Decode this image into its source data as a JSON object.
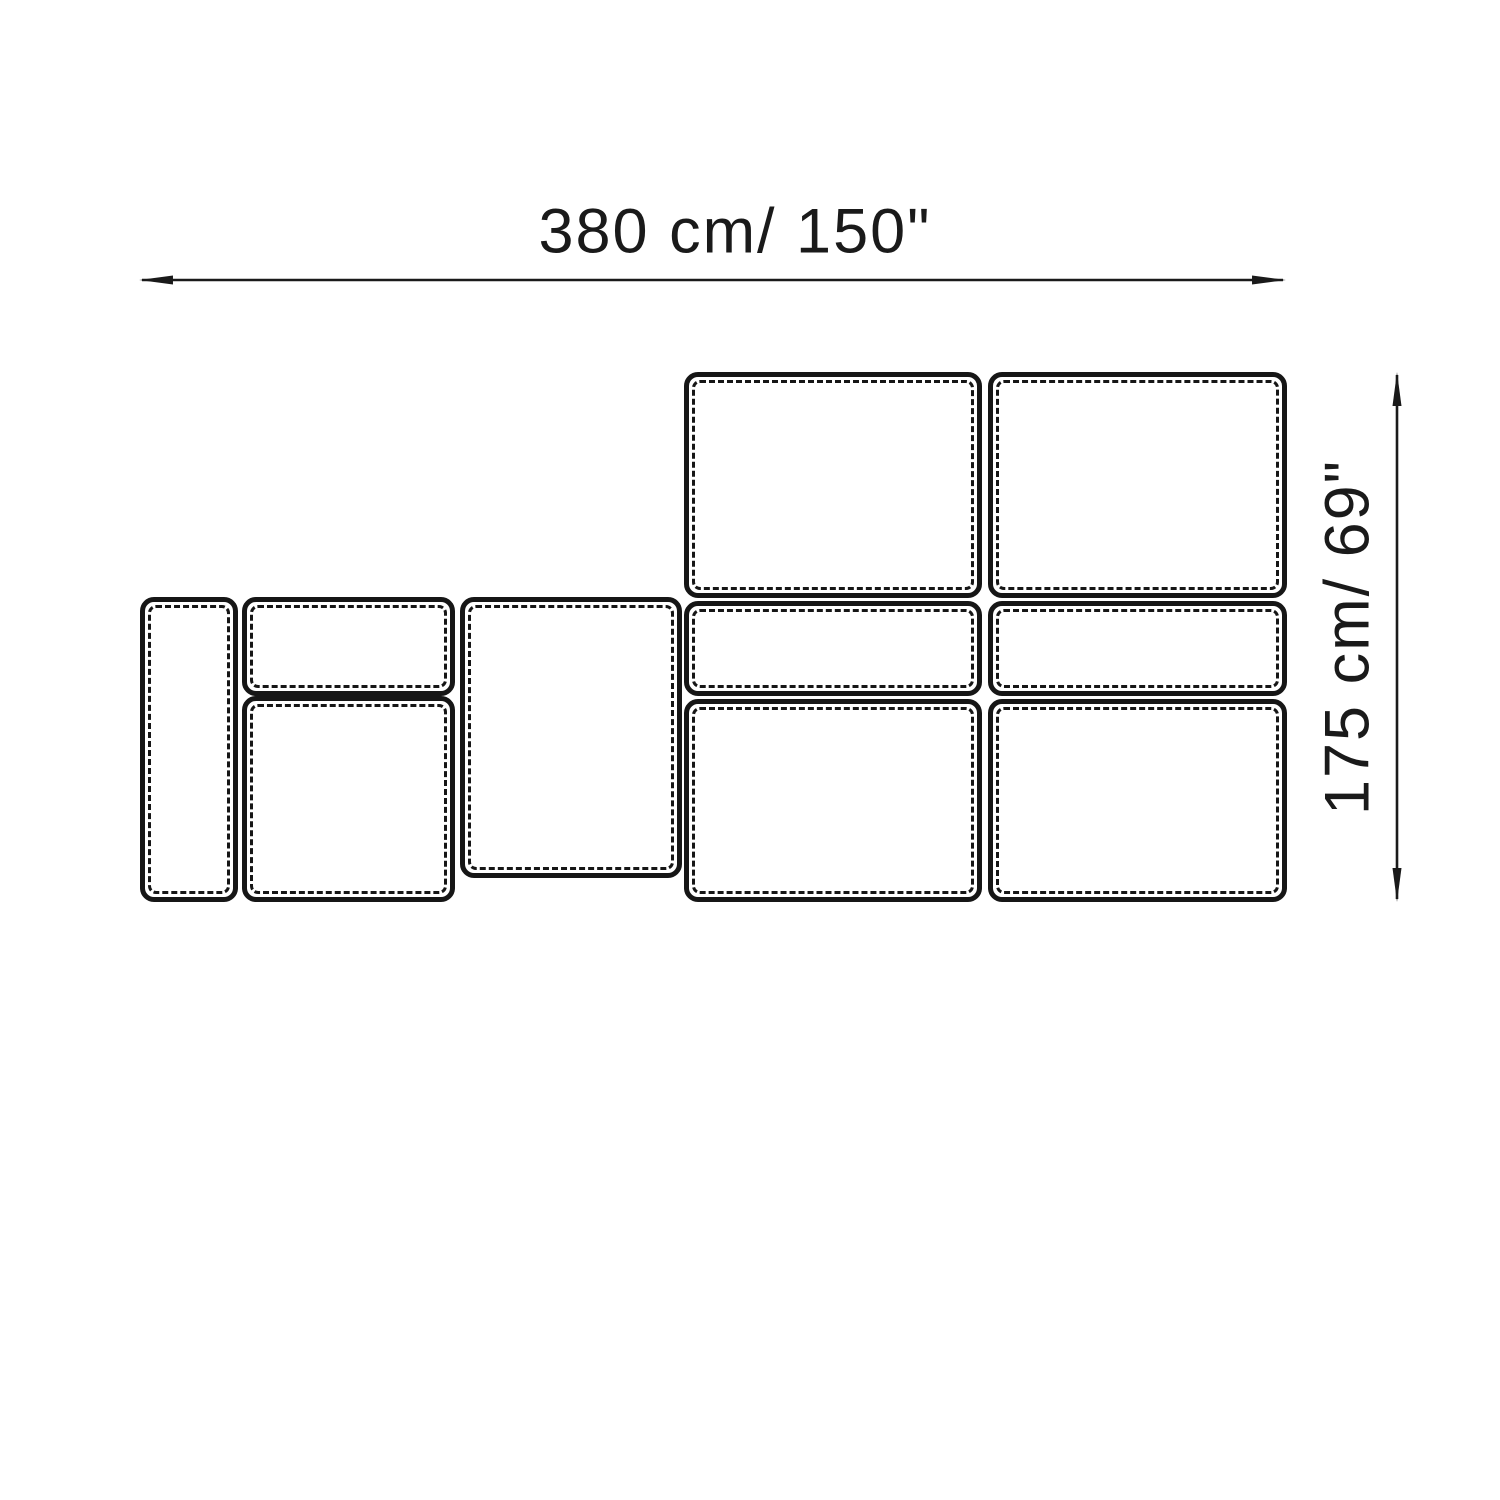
{
  "diagram": {
    "width_dimension": {
      "label": "380 cm/ 150\""
    },
    "height_dimension": {
      "label": "175 cm/ 69\""
    },
    "colors": {
      "line": "#1a1a1a",
      "background": "#ffffff"
    }
  }
}
